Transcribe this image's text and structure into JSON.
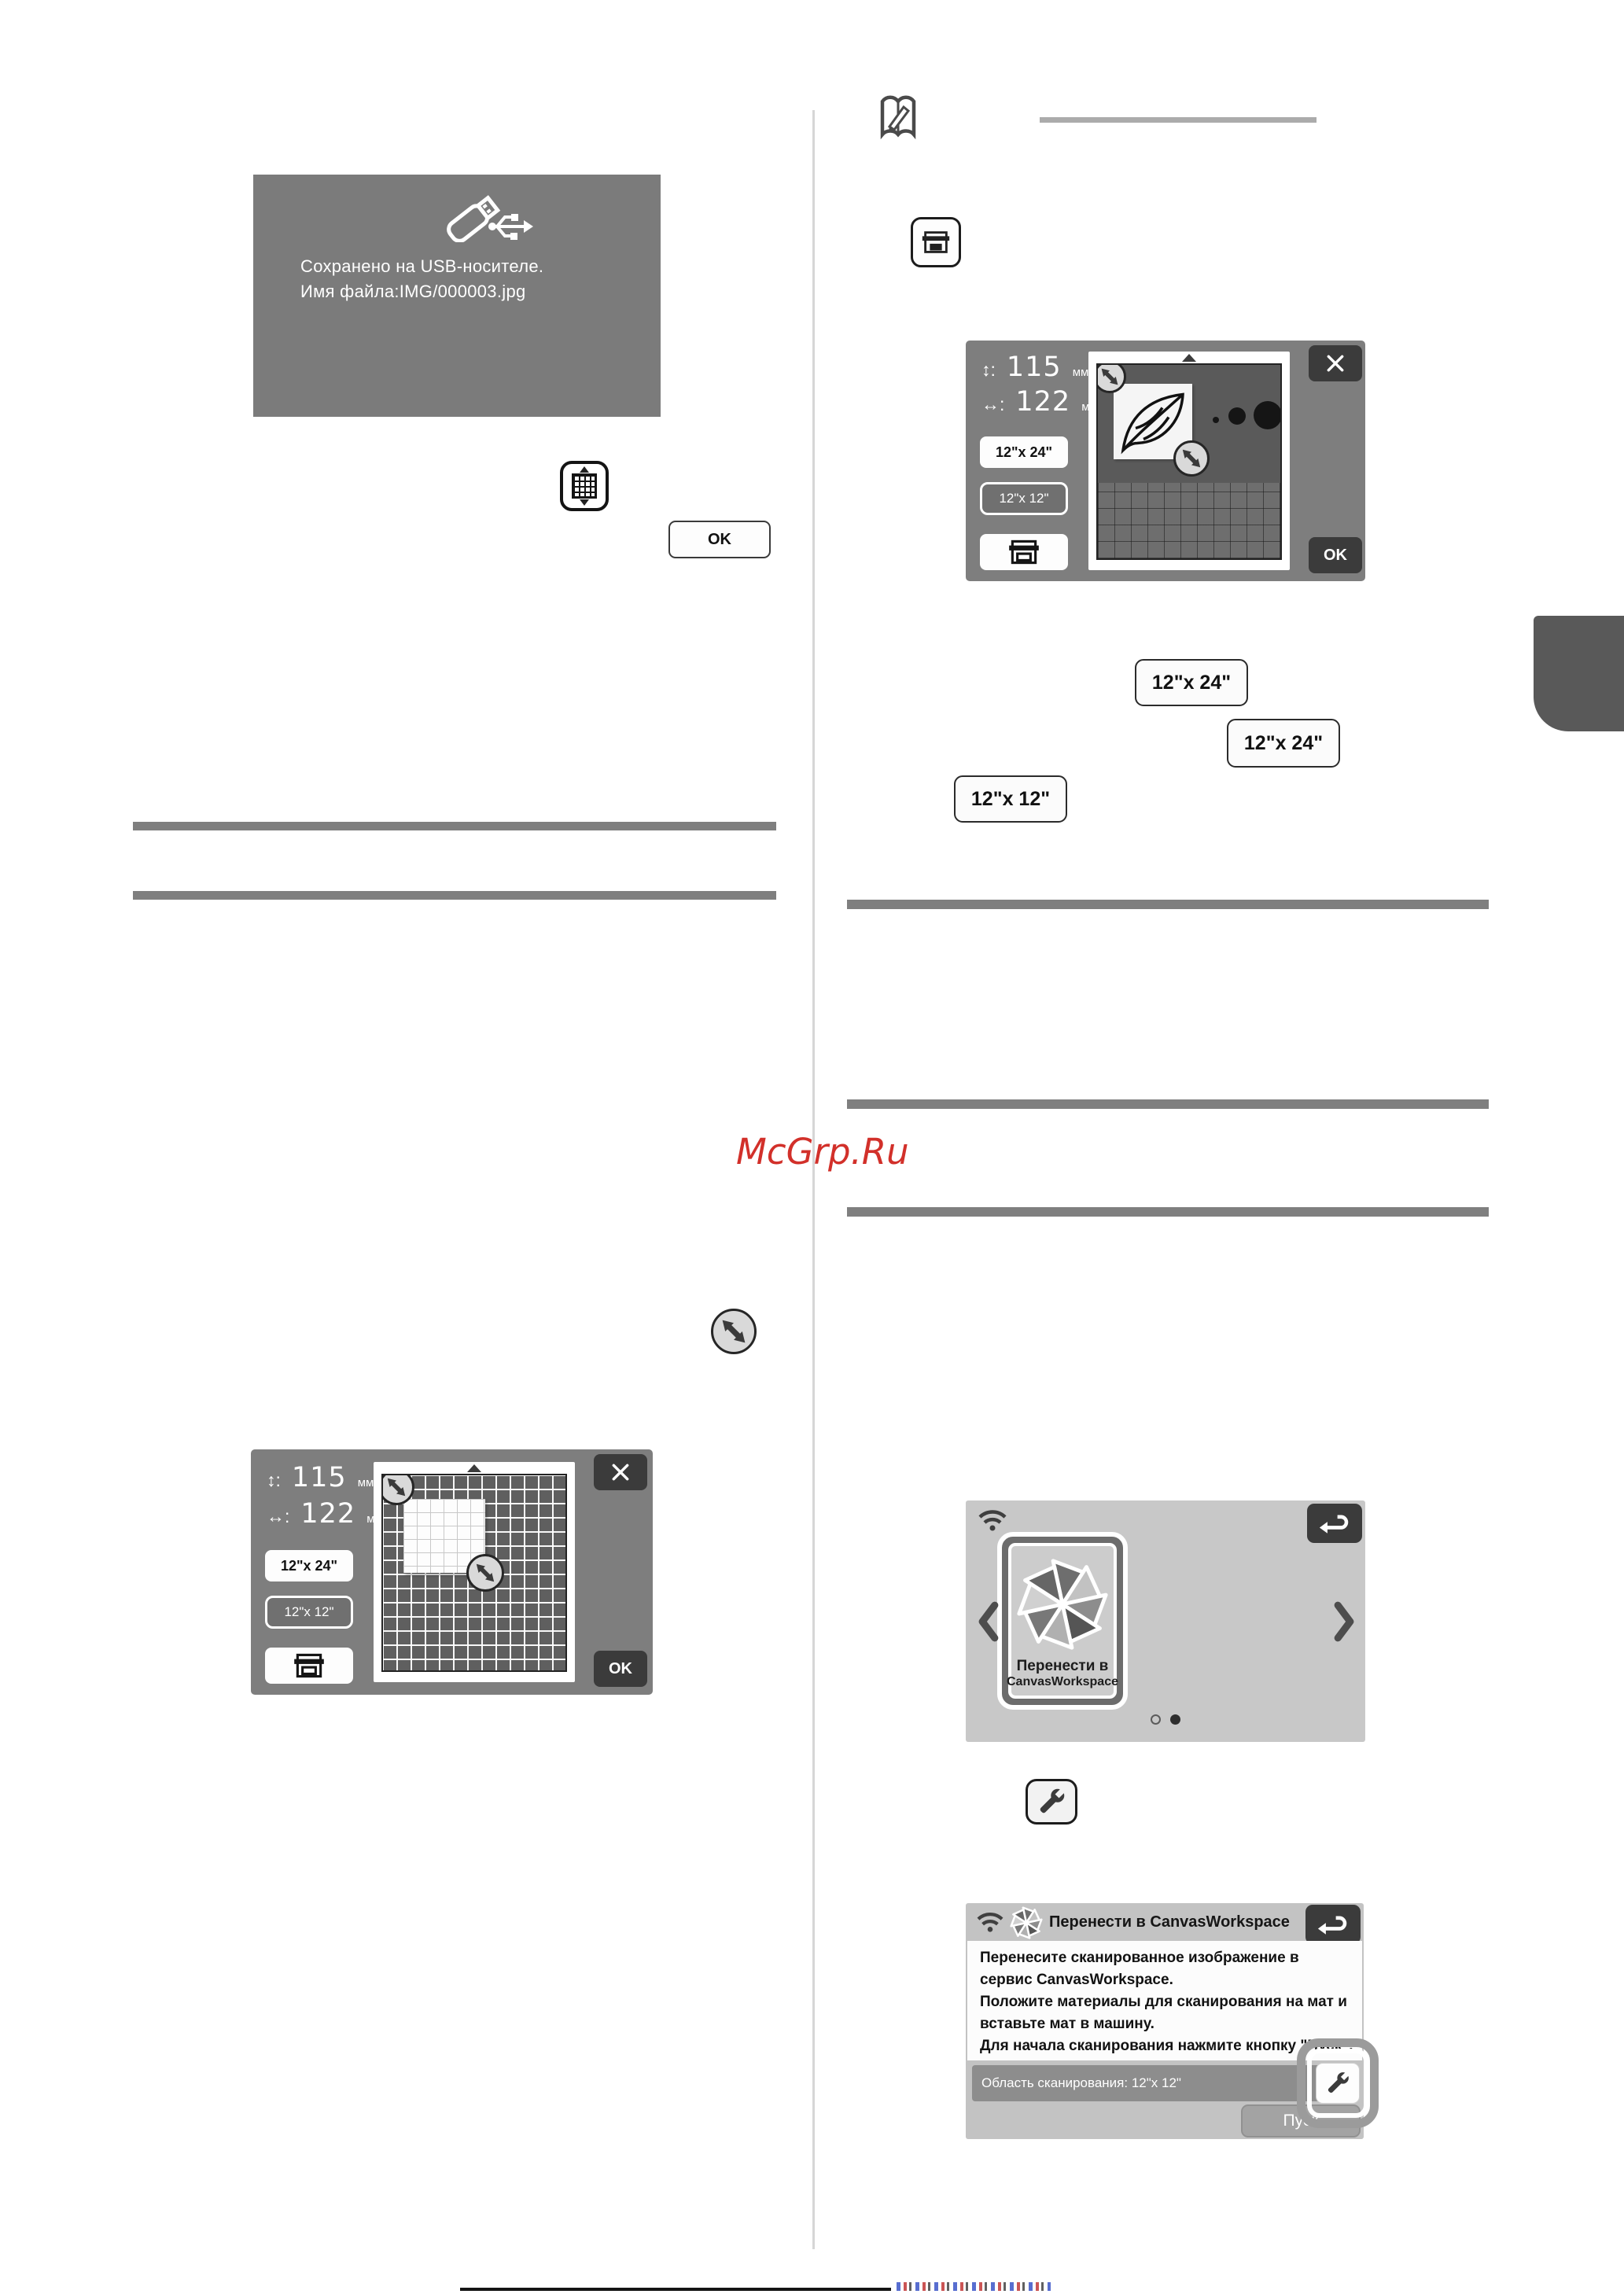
{
  "watermark": {
    "text": "McGrp.Ru",
    "color": "#d2302a"
  },
  "usb_dialog": {
    "message_line1": "Сохранено на USB-носителе.",
    "message_line2": "Имя файла:IMG/000003.jpg",
    "ok_label": "OK"
  },
  "scan_screen_leaf": {
    "height_label": "↕:",
    "height_value": "115",
    "height_unit": "мм",
    "width_label": "↔:",
    "width_value": "122",
    "width_unit": "мм",
    "size_button_12x24": "12\"x 24\"",
    "size_button_12x12": "12\"x 12\"",
    "ok_label": "OK"
  },
  "scan_screen_grid": {
    "height_label": "↕:",
    "height_value": "115",
    "height_unit": "мм",
    "width_label": "↔:",
    "width_value": "122",
    "width_unit": "мм",
    "size_button_12x24": "12\"x 24\"",
    "size_button_12x12": "12\"x 12\"",
    "ok_label": "OK"
  },
  "size_buttons": {
    "top_12x24": "12\"x 24\"",
    "middle_12x24": "12\"x 24\"",
    "bottom_12x12": "12\"x 12\""
  },
  "canvas_home": {
    "card_line1": "Перенести в",
    "card_line2": "CanvasWorkspace"
  },
  "transfer_dialog": {
    "title": "Перенести в CanvasWorkspace",
    "body_lines": [
      "Перенесите сканированное изображение в",
      "сервис CanvasWorkspace.",
      "Положите материалы для сканирования на мат и",
      "вставьте мат в машину.",
      "Для начала сканирования нажмите кнопку \"Пуск\"."
    ],
    "scan_area_label": "Область сканирования: 12\"x 12\"",
    "start_label": "Пуск"
  }
}
